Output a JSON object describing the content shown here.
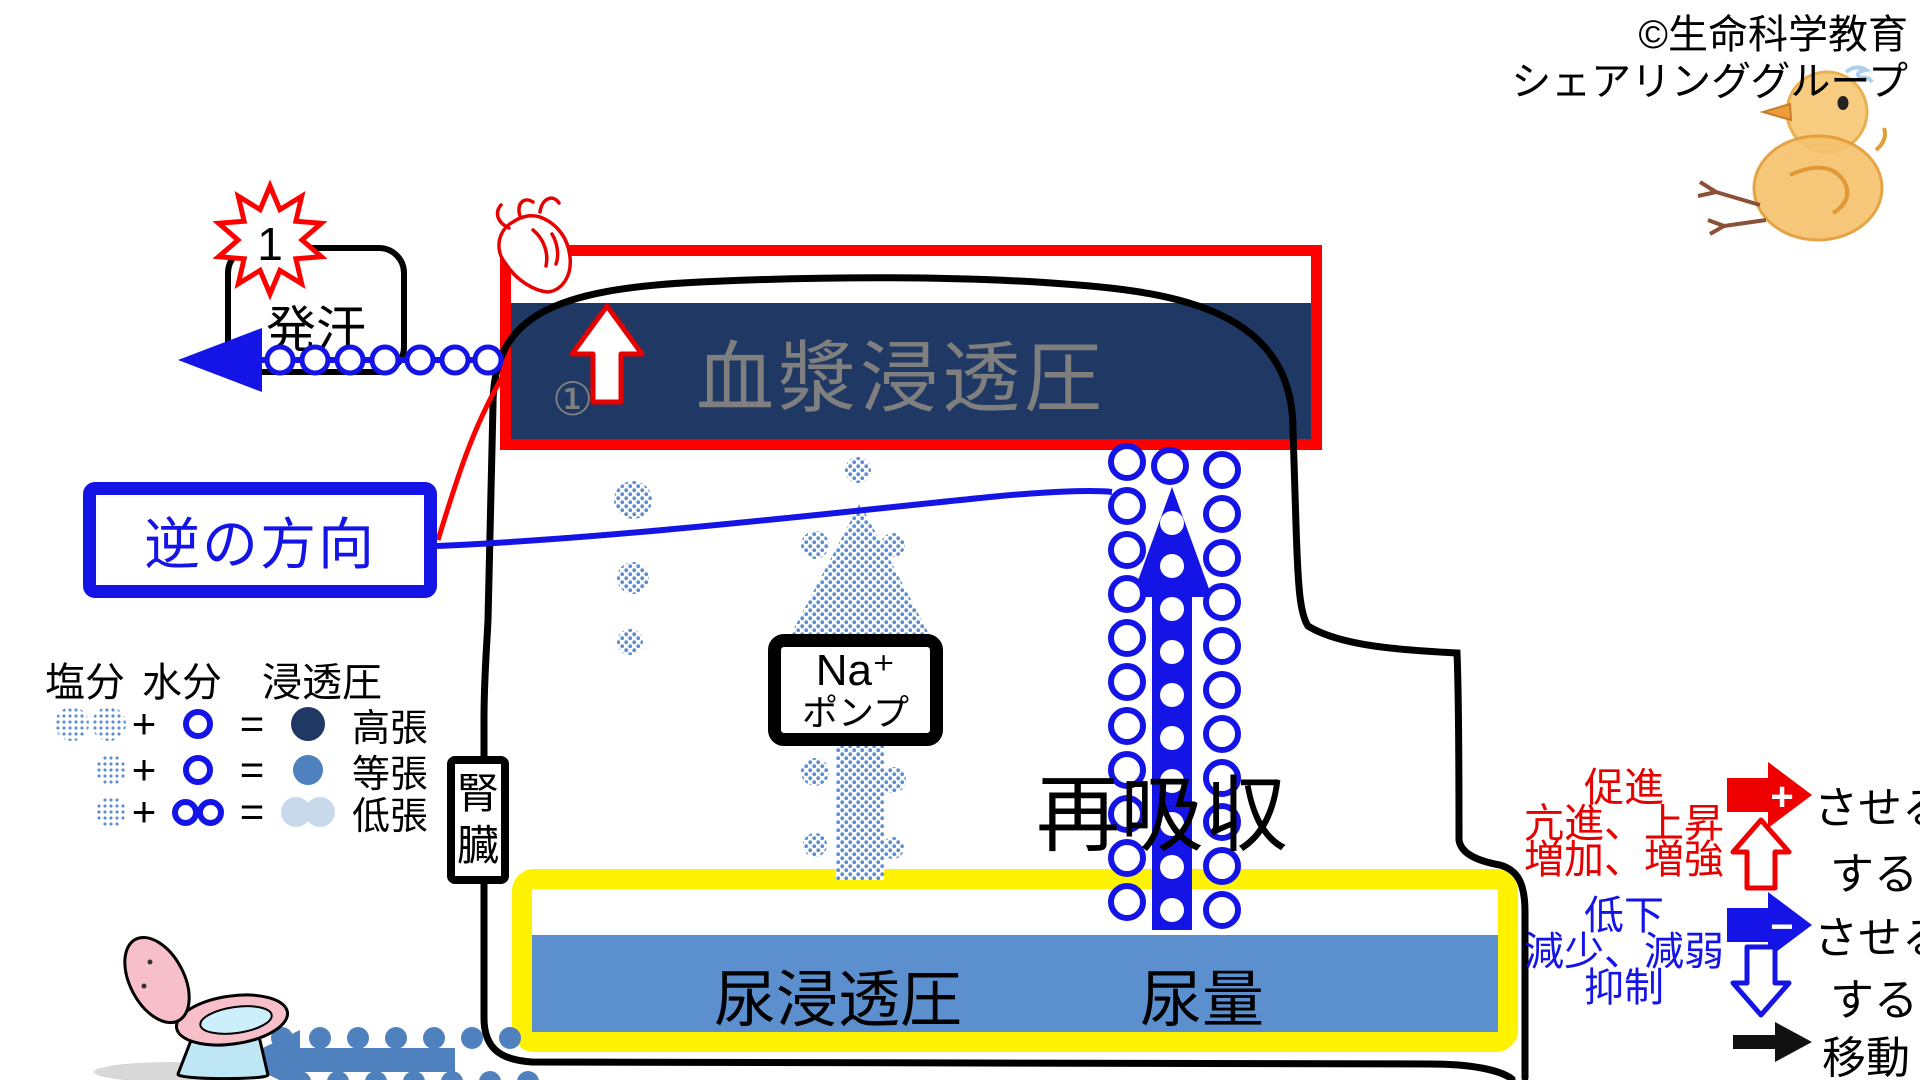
{
  "copyright": {
    "line1": "©生命科学教育",
    "line2": "シェアリンググループ"
  },
  "sweat": {
    "badge": "1",
    "label": "発汗"
  },
  "plasma": {
    "label": "血漿浸透圧",
    "marker": "①"
  },
  "reverse": {
    "label": "逆の方向"
  },
  "legend": {
    "col_salt": "塩分",
    "col_water": "水分",
    "col_osmo": "浸透圧",
    "plus": "+",
    "equals": "=",
    "hyper": "高張",
    "iso": "等張",
    "hypo": "低張"
  },
  "kidney": {
    "char1": "腎",
    "char2": "臓"
  },
  "pump": {
    "line1": "Na⁺",
    "line2": "ポンプ"
  },
  "reabsorption": "再吸収",
  "urine": {
    "osmolarity": "尿浸透圧",
    "volume": "尿量"
  },
  "key": {
    "up": {
      "l1": "促進",
      "l2": "亢進、上昇",
      "l3": "増加、増強",
      "cause": "させる",
      "does": "する",
      "sign": "+"
    },
    "down": {
      "l1": "低下",
      "l2": "減少、減弱",
      "l3": "抑制",
      "cause": "させる",
      "does": "する",
      "sign": "−"
    },
    "move": "移動"
  },
  "colors": {
    "red": "#FF0000",
    "blue": "#1414E6",
    "navy": "#1F3864",
    "mid_blue": "#4E81BD",
    "light_blue": "#C9D9EC",
    "yellow": "#FFF200",
    "gray_text": "#7F7F7F"
  }
}
